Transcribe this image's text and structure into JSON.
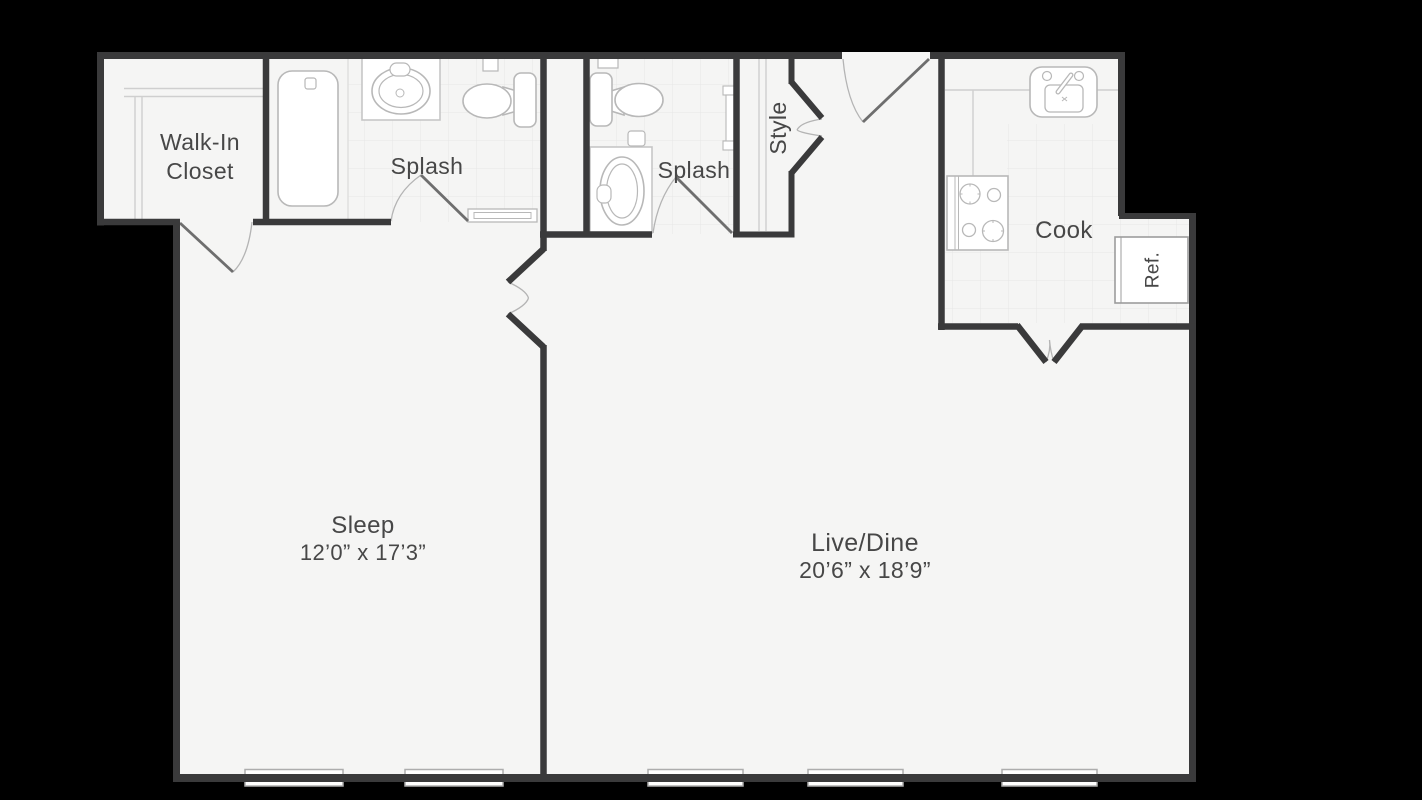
{
  "meta": {
    "drawing_type": "apartment floor plan"
  },
  "colors": {
    "background": "#000000",
    "floor": "#f5f5f4",
    "wall": "#3a3a3b",
    "fixture_line": "#b8b8b8",
    "tile_line": "#e7e7e6",
    "door_leaf": "#6e6e6e",
    "swing_arc": "#b4b4b4",
    "label": "#474747"
  },
  "rooms": {
    "walk_in_closet": {
      "name": "Walk-In Closet",
      "name_line1": "Walk-In",
      "name_line2": "Closet"
    },
    "bath1": {
      "name": "Splash"
    },
    "bath2": {
      "name": "Splash"
    },
    "style_closet": {
      "name": "Style"
    },
    "kitchen": {
      "name": "Cook"
    },
    "refrigerator": {
      "name": "Ref."
    },
    "sleep": {
      "name": "Sleep",
      "dimensions": "12’0” x 17’3”"
    },
    "live_dine": {
      "name": "Live/Dine",
      "dimensions": "20’6” x 18’9”"
    }
  },
  "fixtures": [
    "bathtub",
    "vanity-sink",
    "toilet",
    "shower-threshold",
    "toilet",
    "vanity-sink",
    "shower-panel",
    "stove",
    "kitchen-sink",
    "refrigerator",
    "closet-shelving"
  ],
  "windows": {
    "count": 5
  }
}
